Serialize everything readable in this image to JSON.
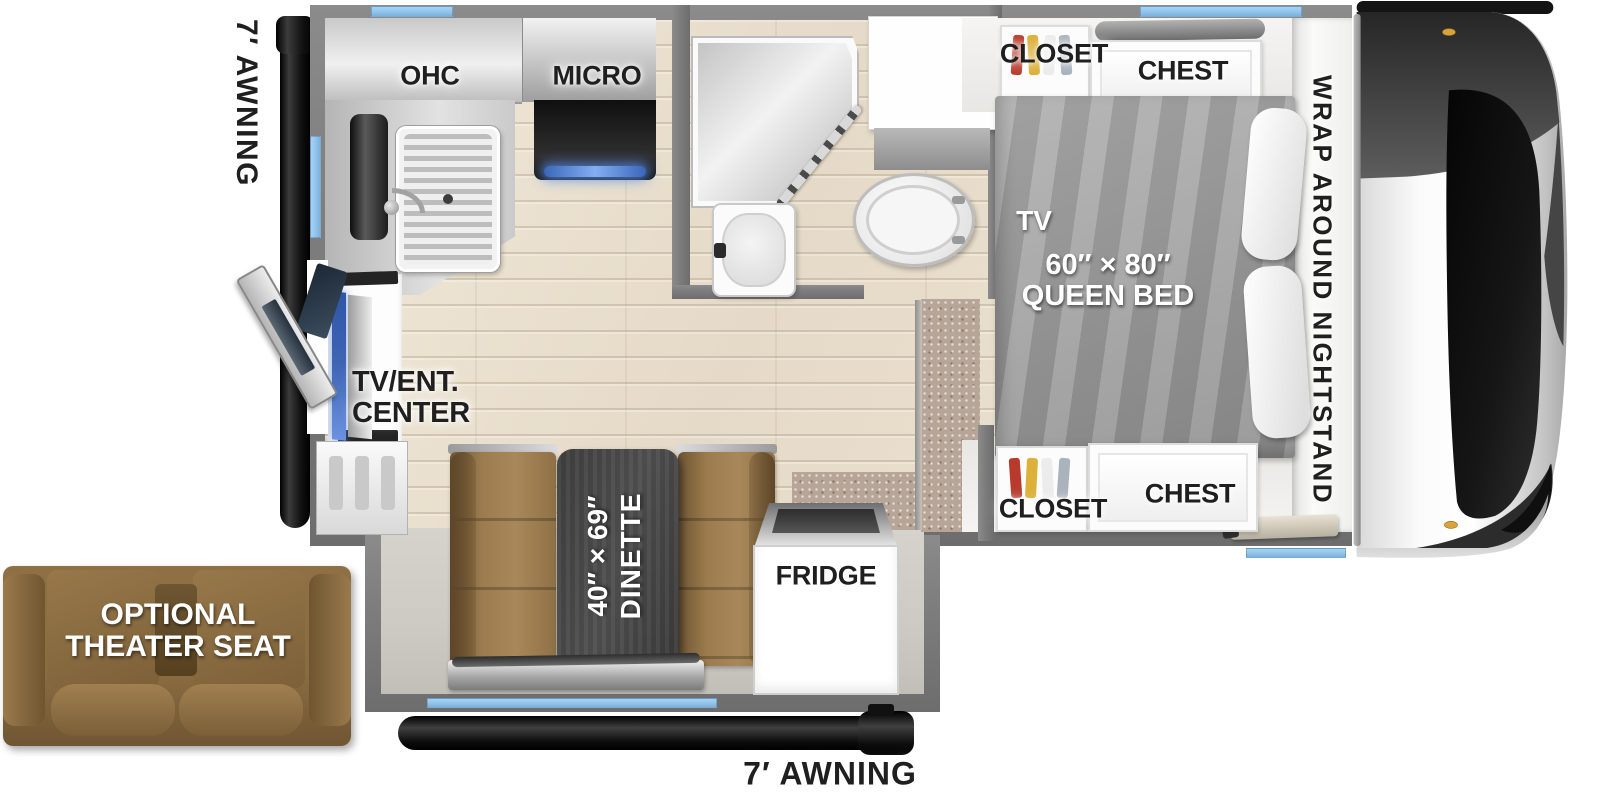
{
  "colors": {
    "wall": "#7c7c7c",
    "floor": "#eadfd1",
    "bump_floor": "#cdc9c3",
    "carpet": "#b7a698",
    "window": "#8ec2ea",
    "awning": "#1c1c1c",
    "dinette_brown": "#9a7b4d",
    "table": "#424242",
    "bed": "#9e9e9e",
    "seat_brown": "#8a6c41",
    "label_dark": "#1f1f1f",
    "tv_screen": "#3f66b4"
  },
  "exterior": {
    "awning_left_label": "7′ AWNING",
    "awning_bottom_label": "7′ AWNING",
    "theater_seat_line1": "OPTIONAL",
    "theater_seat_line2": "THEATER SEAT"
  },
  "kitchen": {
    "ohc_label": "OHC",
    "micro_label": "MICRO"
  },
  "living": {
    "tv_ent_line1": "TV/ENT.",
    "tv_ent_line2": "CENTER",
    "dinette_size_label": "40″ × 69″",
    "dinette_name_label": "DINETTE",
    "fridge_label": "FRIDGE"
  },
  "bedroom": {
    "closet_top_label": "CLOSET",
    "chest_top_label": "CHEST",
    "closet_bottom_label": "CLOSET",
    "chest_bottom_label": "CHEST",
    "tv_label": "TV",
    "bed_size_label": "60″ × 80″",
    "bed_name_label": "QUEEN BED",
    "nightstand_label": "WRAP AROUND NIGHTSTAND"
  }
}
